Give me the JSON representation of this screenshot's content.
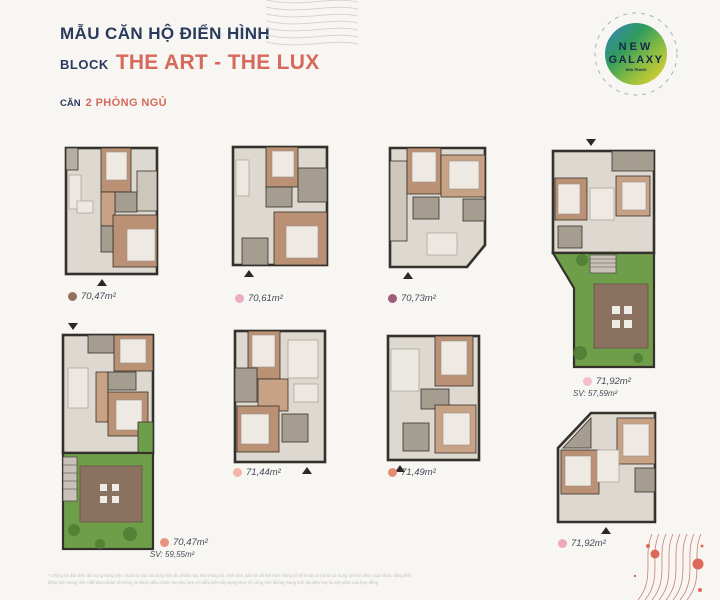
{
  "header": {
    "title": "MẪU CĂN HỘ ĐIỂN HÌNH",
    "block_prefix": "BLOCK",
    "block_name": "THE ART - THE LUX",
    "unit_prefix": "CĂN",
    "unit_type": "2 PHÒNG NGỦ"
  },
  "logo": {
    "line1": "NEW",
    "line2": "GALAXY",
    "subtitle": "NHA TRANG"
  },
  "plans": [
    {
      "area": "70,47m²",
      "dot_color": "#96705f"
    },
    {
      "area": "70,61m²",
      "dot_color": "#ebabc3"
    },
    {
      "area": "70,73m²",
      "dot_color": "#a05a7a"
    },
    {
      "area": "71,92m²",
      "sv": "SV: 57,59m²",
      "dot_color": "#f4bccd"
    },
    {
      "area": "70,47m²",
      "sv": "SV: 59,55m²",
      "dot_color": "#e8937d"
    },
    {
      "area": "71,44m²",
      "dot_color": "#f3b6a6"
    },
    {
      "area": "71,49m²",
      "dot_color": "#e78a73"
    },
    {
      "area": "71,92m²",
      "dot_color": "#eda7bf"
    }
  ],
  "footer": {
    "line1": "* Chúng tôi đặc biệt cẩn trọng trong việc chuẩn bị các nội dung trên ấn phẩm này. Mọi thông tin, hình ảnh, bản vẽ chỉ thể hiện thông số kỹ thuật và vật tư sử dụng tại thời điểm soạn thảo, đồng thời",
    "line2": "đồng thời mang tính chất tham khảo và thông tin được điều chỉnh cho phù hợp với điều kiện xây dựng thực tế, cũng như không mang tính đại diện hay là một phần của hợp đồng."
  },
  "colors": {
    "title_navy": "#2a3a5c",
    "accent_salmon": "#d5695a",
    "wall": "#35302a",
    "floor": "#ddd9d1",
    "wood": "#bb9175",
    "gray_room": "#a49d90",
    "garden_green": "#6f9e4b",
    "deck_brown": "#8a7160",
    "wave_gray": "#d7d5d2",
    "wave_red": "#c97d72"
  }
}
